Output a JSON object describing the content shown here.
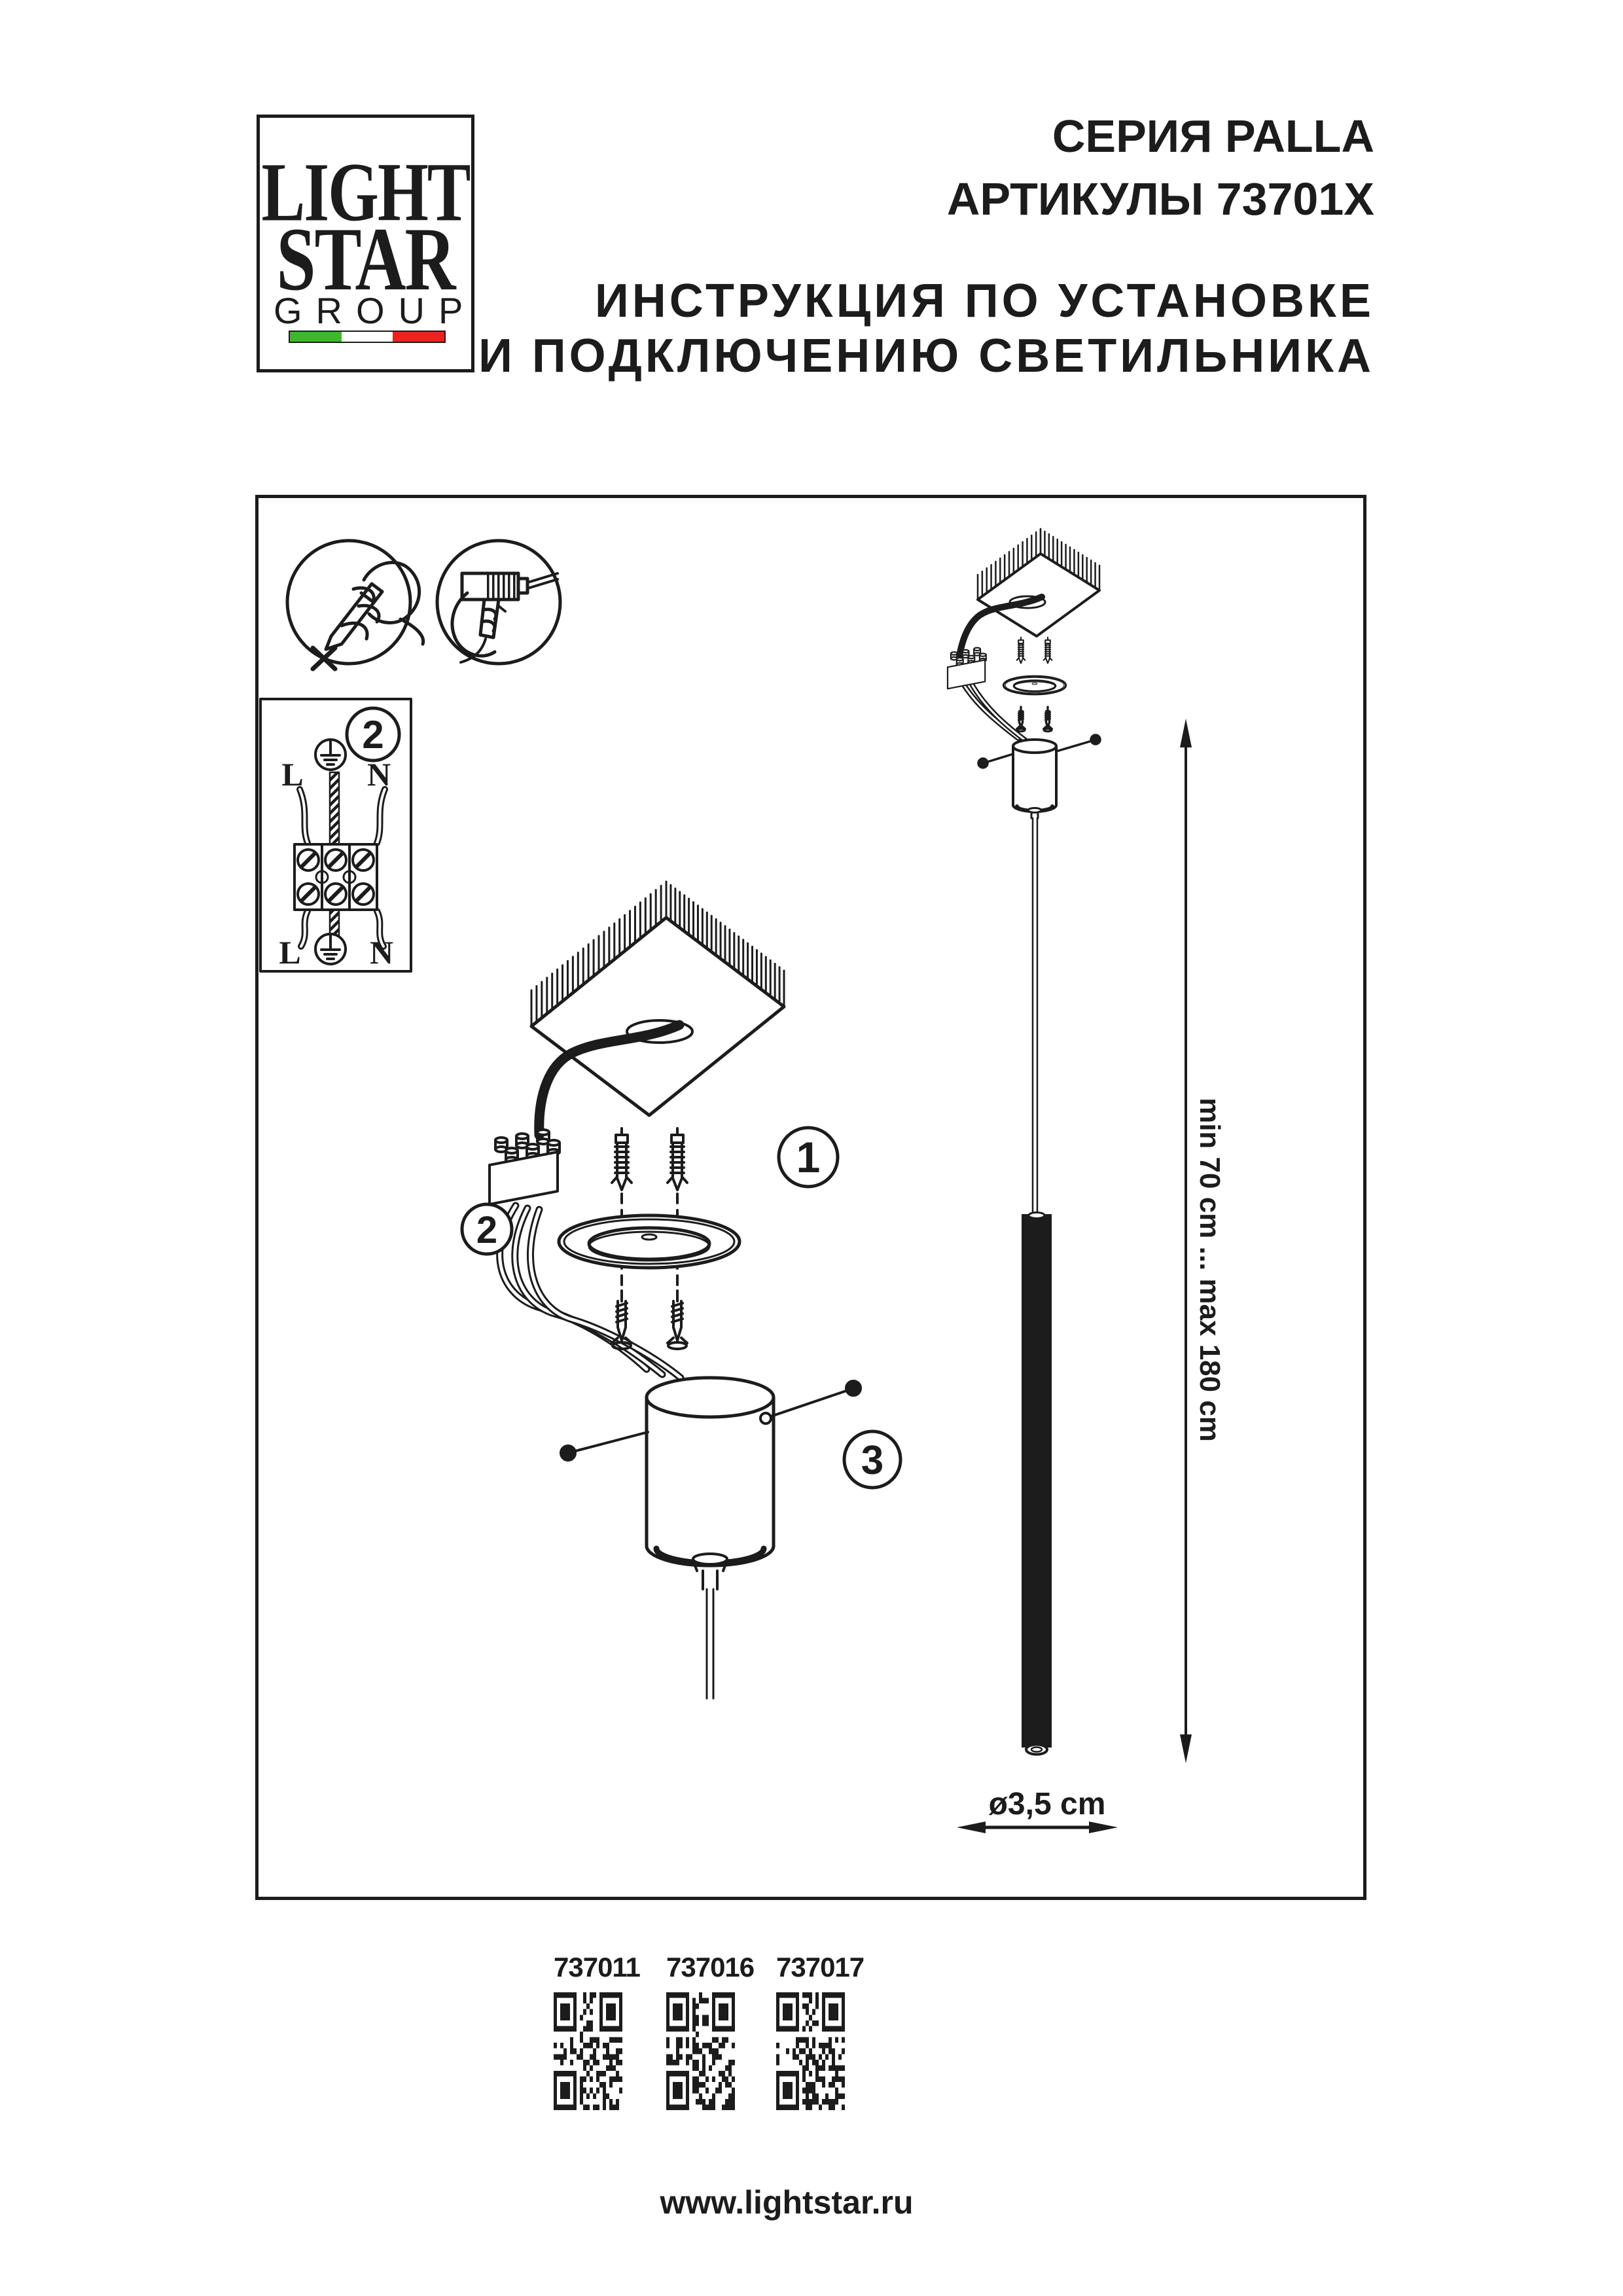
{
  "header": {
    "logo": {
      "line1": "LIGHT",
      "line2": "STAR",
      "line3": "GROUP"
    },
    "series_title": "СЕРИЯ PALLA",
    "articles_title": "АРТИКУЛЫ 73701X",
    "instruction_line1": "ИНСТРУКЦИЯ ПО УСТАНОВКЕ",
    "instruction_line2": "И ПОДКЛЮЧЕНИЮ СВЕТИЛЬНИКА"
  },
  "diagram": {
    "icons": [
      {
        "name": "mark-position-icon"
      },
      {
        "name": "drill-icon"
      }
    ],
    "wiring_box": {
      "step_label": "2",
      "live_label": "L",
      "neutral_label": "N"
    },
    "step_labels": {
      "anchors": "1",
      "terminal": "2",
      "set_screws": "3"
    },
    "dimensions": {
      "suspension_range": "min 70 cm ... max 180 cm",
      "tube_diameter": "ø3,5 cm"
    }
  },
  "products": [
    {
      "code": "737011"
    },
    {
      "code": "737016"
    },
    {
      "code": "737017"
    }
  ],
  "footer": {
    "website": "www.lightstar.ru"
  },
  "colors": {
    "ink": "#1c1c1c",
    "flag_green": "#3eb829",
    "flag_white": "#ffffff",
    "flag_red": "#e8241f"
  }
}
